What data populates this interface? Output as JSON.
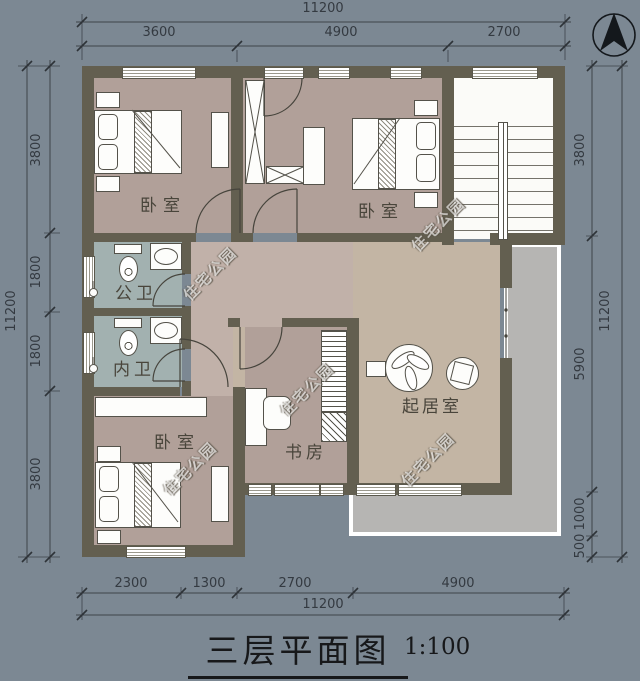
{
  "title": {
    "text": "三层平面图",
    "scale": "1:100"
  },
  "rooms": {
    "bedroom_top_left": "卧室",
    "bedroom_top_right": "卧室",
    "bedroom_bottom_left": "卧室",
    "public_bathroom": "公卫",
    "private_bathroom": "内卫",
    "study": "书房",
    "living_room": "起居室"
  },
  "watermark": {
    "text": "住宅公园"
  },
  "dimensions": {
    "top": {
      "total": "11200",
      "segments": [
        "3600",
        "4900",
        "2700"
      ]
    },
    "bottom": {
      "total": "11200",
      "segments": [
        "2300",
        "1300",
        "2700",
        "4900"
      ]
    },
    "left": {
      "total": "11200",
      "segments": [
        "3800",
        "1800",
        "1800",
        "3800"
      ]
    },
    "right": {
      "total": "11200",
      "segments": [
        "3800",
        "5900",
        "1000",
        "500"
      ]
    }
  },
  "icons": {
    "compass": "north-arrow-icon"
  },
  "colors": {
    "bg": "#7c8893",
    "wall": "#635f50",
    "bedroom_floor": "#b1a099",
    "bath_floor": "#a2b1b0",
    "hall_floor": "#c1b1a9",
    "living_floor": "#c3b5a4",
    "stair_floor": "#fbfbf8",
    "terrace": "#b6b5b3",
    "line": "#3e434a",
    "label": "#49453b"
  }
}
